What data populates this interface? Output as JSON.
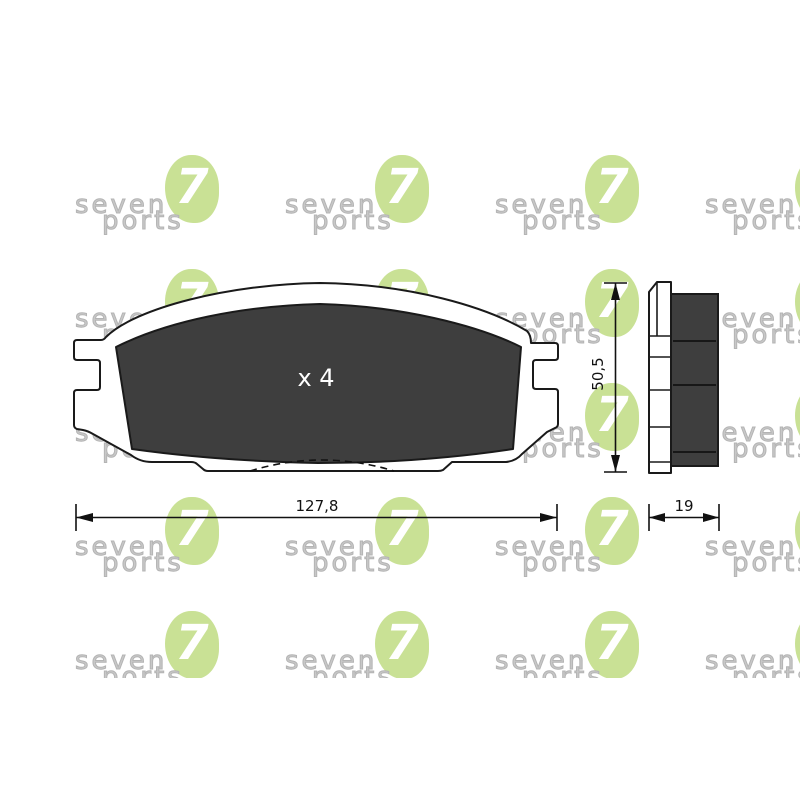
{
  "drawing": {
    "quantity_label": "x 4",
    "front_view": {
      "name": "brake-pad-front-view",
      "width_dimension": "127,8",
      "height_dimension": "50,5"
    },
    "side_view": {
      "name": "brake-pad-side-view",
      "depth_dimension": "19"
    }
  },
  "watermark": {
    "line1": "seven",
    "line2": "ports",
    "digit": "7",
    "columns_x": [
      75,
      285,
      495,
      705
    ],
    "rows_y": [
      155,
      269,
      383,
      497,
      611
    ],
    "colors": {
      "green": "#c9e195",
      "text": "#c8c8c8"
    }
  },
  "colors": {
    "friction_material": "#3e3e3e",
    "outline": "#1a1a1a",
    "background": "#ffffff"
  }
}
